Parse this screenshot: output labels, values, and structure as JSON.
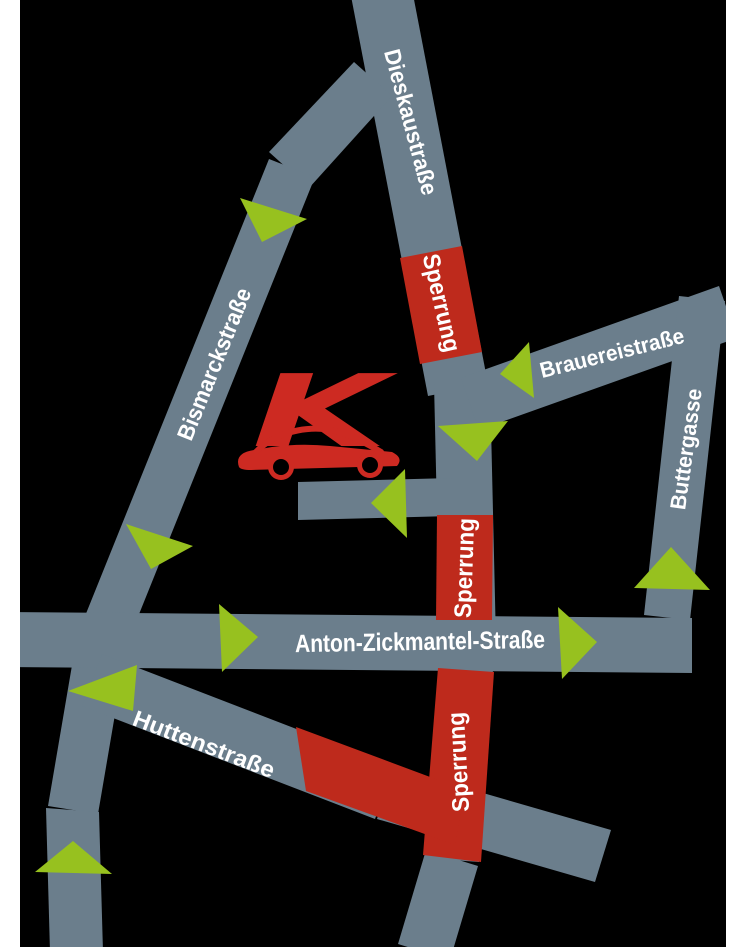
{
  "page": {
    "background": "#ffffff",
    "canvas": {
      "x": 20,
      "y": 0,
      "width": 706,
      "height": 947,
      "background": "#000000"
    }
  },
  "colors": {
    "street": "#6B7E8C",
    "closure": "#BE2A1C",
    "arrow": "#97C11F",
    "label": "#FFFFFF",
    "logo": "#CD2A22",
    "window": "#000000"
  },
  "map": {
    "streets": [
      {
        "name": "street-dieskaustrasse-north",
        "points": "351,-4 411,-16 488,384 428,396"
      },
      {
        "name": "street-dieskaustrasse-mid",
        "points": "434,383 490,383 496,642 440,642"
      },
      {
        "name": "street-dieskaustrasse-south",
        "points": "441,638 495,642 479,862 425,858"
      },
      {
        "name": "street-dieskaustrasse-bottom",
        "points": "426,850 478,866 450,960 398,944"
      },
      {
        "name": "street-bismarck-branch",
        "points": "354,62 392,96 309,188 269,152"
      },
      {
        "name": "street-bismarck-main",
        "points": "269,159 315,177 125,649 79,631"
      },
      {
        "name": "street-bismarck-lower",
        "points": "77,636 127,644 98,814 48,806"
      },
      {
        "name": "street-bismarck-bottom",
        "points": "46,808 99,812 103,952 50,952"
      },
      {
        "name": "street-brauereistrasse",
        "points": "461,378 719,286 737,338 479,430"
      },
      {
        "name": "street-buttergasse",
        "points": "679,296 725,301 690,620 644,615"
      },
      {
        "name": "street-anton-zickmantel",
        "points": "10,612 692,618 692,673 10,667"
      },
      {
        "name": "street-huttenstrasse-west",
        "points": "102,654 395,767 375,819 82,706"
      },
      {
        "name": "street-huttenstrasse-east",
        "points": "393,767 611,830 595,882 377,819"
      },
      {
        "name": "street-dealership-access",
        "points": "298,482 452,478 452,516 298,520"
      }
    ],
    "closures": [
      {
        "name": "closure-dieskaustrasse-north",
        "points": "400,258 462,246 482,352 420,364"
      },
      {
        "name": "closure-dieskaustrasse-mid",
        "points": "437,515 493,515 492,620 436,620"
      },
      {
        "name": "closure-dieskaustrasse-south",
        "points": "438,668 494,672 481,862 423,855"
      },
      {
        "name": "closure-huttenstrasse",
        "points": "296,727 465,790 455,845 306,791"
      }
    ],
    "arrows": [
      {
        "name": "arrow-bismarck-north",
        "points": "240,198 262,242 307,219"
      },
      {
        "name": "arrow-brauereistrasse",
        "points": "529,342 534,398 500,374"
      },
      {
        "name": "arrow-dieskau-down",
        "points": "438,426 508,421 477,461"
      },
      {
        "name": "arrow-access-left",
        "points": "405,469 407,538 371,503"
      },
      {
        "name": "arrow-bismarck-mid",
        "points": "126,524 151,569 193,546"
      },
      {
        "name": "arrow-anton-west",
        "points": "219,604 222,672 258,637"
      },
      {
        "name": "arrow-anton-east",
        "points": "558,607 562,679 597,642"
      },
      {
        "name": "arrow-huttenstrasse",
        "points": "137,665 133,711 68,691"
      },
      {
        "name": "arrow-buttergasse",
        "points": "671,547 634,588 710,590"
      },
      {
        "name": "arrow-bismarck-south",
        "points": "73,841 35,872 112,874"
      }
    ],
    "labels": [
      {
        "name": "label-dieskaustrasse",
        "text": "Dieskaustraße",
        "x": 411,
        "y": 122,
        "rotate": 75,
        "size": 23,
        "length": 150
      },
      {
        "name": "label-sperrung-north",
        "text": "Sperrung",
        "x": 441,
        "y": 303,
        "rotate": 77,
        "size": 24,
        "length": 100
      },
      {
        "name": "label-brauereistrasse",
        "text": "Brauereistraße",
        "x": 612,
        "y": 353,
        "rotate": -14,
        "size": 22,
        "length": 148
      },
      {
        "name": "label-buttergasse",
        "text": "Buttergasse",
        "x": 686,
        "y": 449,
        "rotate": -82,
        "size": 22,
        "length": 122
      },
      {
        "name": "label-bismarckstrasse",
        "text": "Bismarckstraße",
        "x": 214,
        "y": 364,
        "rotate": -68,
        "size": 23,
        "length": 162
      },
      {
        "name": "label-sperrung-mid",
        "text": "Sperrung",
        "x": 465,
        "y": 568,
        "rotate": -88,
        "size": 24,
        "length": 100
      },
      {
        "name": "label-anton-zickmantel",
        "text": "Anton-Zickmantel-Straße",
        "x": 420,
        "y": 642,
        "rotate": -1,
        "size": 25,
        "length": 250
      },
      {
        "name": "label-sperrung-south",
        "text": "Sperrung",
        "x": 459,
        "y": 762,
        "rotate": -93,
        "size": 24,
        "length": 100
      },
      {
        "name": "label-huttenstrasse",
        "text": "Huttenstraße",
        "x": 204,
        "y": 744,
        "rotate": 21,
        "size": 23,
        "length": 150
      }
    ],
    "logo": {
      "name": "dealership-logo",
      "letter": "K",
      "letter_x": 252,
      "letter_y": 446,
      "letter_size": 100,
      "letter_stretch": 135,
      "body_path": "M239,467 Q234,453 254,450 L272,447 Q300,443 330,446 L392,452 Q404,458 397,466 L251,470 Q241,470 239,467 Z",
      "roof_path": "M256,452 C278,429 316,424 342,433 C357,438 371,446 381,452",
      "wheels": [
        {
          "cx": 281,
          "cy": 467,
          "fender_r": 13,
          "tire_r": 8
        },
        {
          "cx": 370,
          "cy": 465,
          "fender_r": 13,
          "tire_r": 8
        }
      ]
    }
  }
}
